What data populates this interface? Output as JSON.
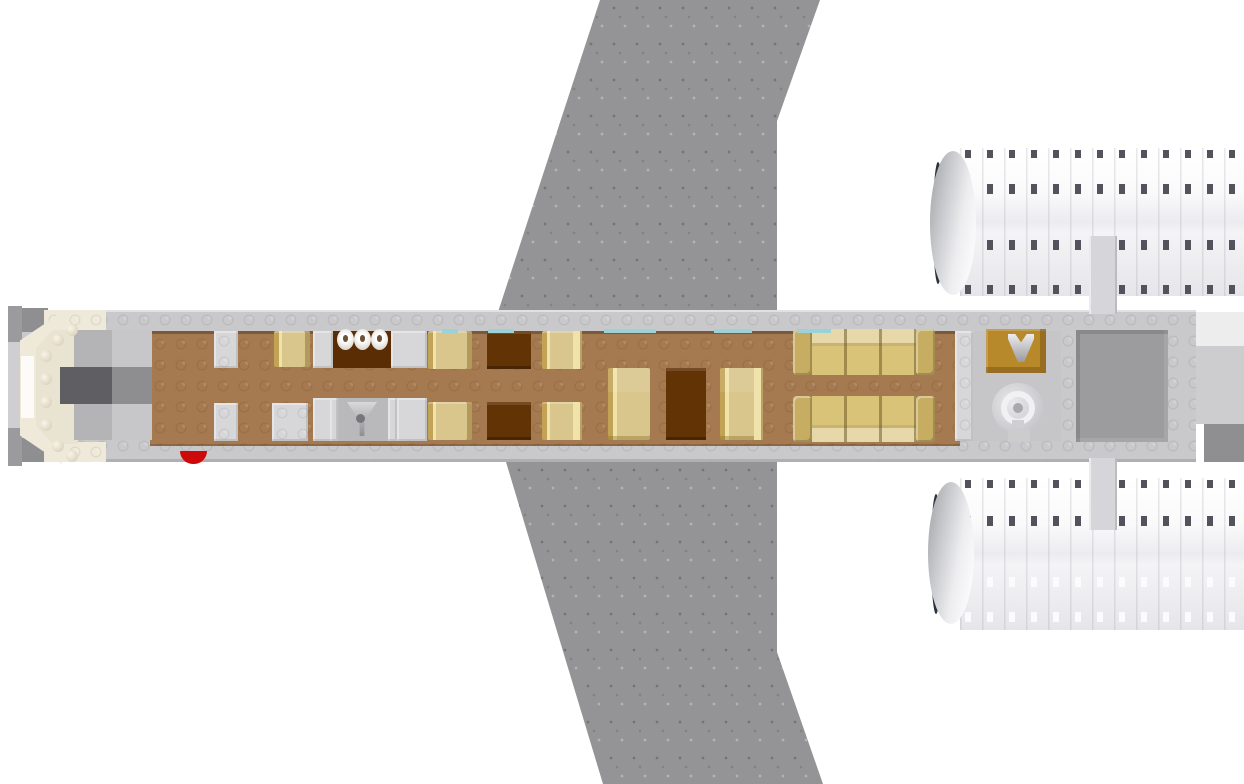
{
  "scene": {
    "type": "3d-brick-model-render",
    "view": "top-down",
    "subject": "passenger-airplane-interior",
    "components": [
      "nose-cockpit",
      "cabin-floor",
      "lavatory-compartments",
      "facing-seat-pairs",
      "dining-benches-with-table",
      "lounge-sofas",
      "galley-counter-with-faucet",
      "toilet",
      "rear-cargo-bay",
      "swept-wings",
      "twin-rear-engines",
      "tail-section",
      "fire-extinguisher",
      "window-strips",
      "engine-pylons"
    ]
  },
  "palette": {
    "background": "#ffffff",
    "wing_gray": "#949496",
    "wall_gray": "#c9c9cc",
    "wall_light": "#d7d7da",
    "floor_brown": "#a67a50",
    "floor_dark": "#5a2d05",
    "table_brown": "#613305",
    "seat_khaki": "#d8c68c",
    "seat_gold": "#c2a254",
    "seat_gold_light": "#f0e2ab",
    "sofa_gold": "#d9c379",
    "sofa_arm": "#c6ad62",
    "ochre_counter": "#b8892b",
    "ivory": "#efe9da",
    "ivory_inner": "#e9e3d2",
    "white_tip": "#fcfbf7",
    "cockpit_dark": "#5f5f63",
    "cockpit_mid": "#8e8e91",
    "red_accent": "#ce0909",
    "engine_lo": "#e6e6ea",
    "intake_rim": "#2a333d",
    "slot_dark": "#53535d",
    "window_teal": "#9ad2d8",
    "cargo_gray": "#9c9c9e",
    "tail_dark": "#8f8f92",
    "pylon_gray": "#d6d6da",
    "toilet_light": "#e3e3e5",
    "metal_gray": "#9f9fa3"
  }
}
